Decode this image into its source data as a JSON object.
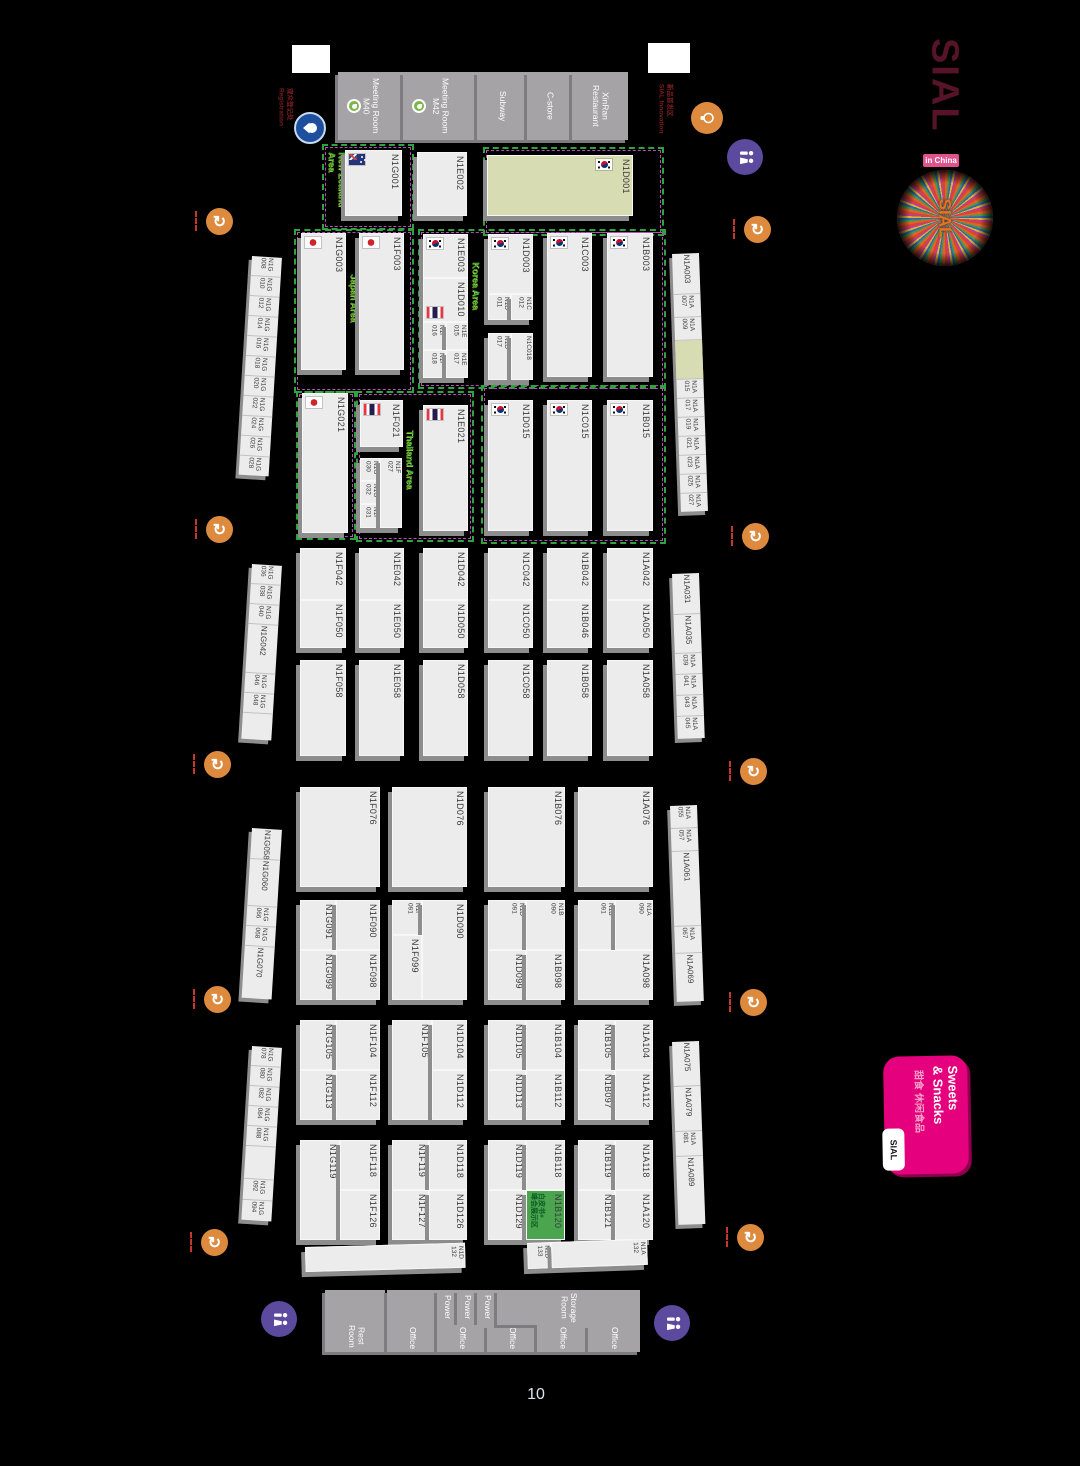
{
  "page_number": "10",
  "sial": {
    "name": "SIAL",
    "badge": "in China",
    "burst": "SIAL"
  },
  "sweets": {
    "title": "Sweets\n& Snacks",
    "cn": "甜食 休闲食品",
    "corner": "SIAL"
  },
  "notes": {
    "registration": "观众登记处\nRegistration",
    "innovation": "新品首发区\nSIAL Innovation"
  },
  "colors": {
    "booth": "#ececec",
    "olive": "#d8dcb2",
    "green_booth": "#4aa54e",
    "area_green": "#2fa43c",
    "area_purple": "#bb4abb",
    "pink": "#e5007d",
    "orange_icon": "#dd8a3e",
    "wc_icon": "#5b4a9e"
  },
  "gaps": [
    {
      "x": 292,
      "y": 45,
      "w": 38,
      "h": 28
    },
    {
      "x": 648,
      "y": 43,
      "w": 42,
      "h": 30
    }
  ],
  "rooms": [
    {
      "x": 338,
      "y": 72,
      "w": 65,
      "h": 68,
      "label": "Meeting Room\nM40",
      "dot": true
    },
    {
      "x": 403,
      "y": 72,
      "w": 74,
      "h": 68,
      "label": "Meeting Room\nM42",
      "dot": true
    },
    {
      "x": 477,
      "y": 72,
      "w": 50,
      "h": 68,
      "label": "Subway"
    },
    {
      "x": 527,
      "y": 72,
      "w": 45,
      "h": 68,
      "label": "C-store"
    },
    {
      "x": 572,
      "y": 72,
      "w": 56,
      "h": 68,
      "label": "XinRan\nRestaurant"
    },
    {
      "x": 325,
      "y": 1290,
      "w": 60,
      "h": 30,
      "label": ""
    },
    {
      "x": 325,
      "y": 1320,
      "w": 62,
      "h": 32,
      "label": "Rest\nRoom"
    },
    {
      "x": 387,
      "y": 1290,
      "w": 50,
      "h": 35,
      "label": ""
    },
    {
      "x": 387,
      "y": 1325,
      "w": 50,
      "h": 27,
      "label": "Office"
    },
    {
      "x": 437,
      "y": 1290,
      "w": 20,
      "h": 35,
      "label": "Power"
    },
    {
      "x": 457,
      "y": 1290,
      "w": 20,
      "h": 35,
      "label": "Power"
    },
    {
      "x": 477,
      "y": 1290,
      "w": 20,
      "h": 35,
      "label": "Power"
    },
    {
      "x": 437,
      "y": 1325,
      "w": 50,
      "h": 27,
      "label": "Office"
    },
    {
      "x": 487,
      "y": 1325,
      "w": 50,
      "h": 27,
      "label": "Office"
    },
    {
      "x": 497,
      "y": 1290,
      "w": 143,
      "h": 35,
      "label": "Storage\nRoom"
    },
    {
      "x": 537,
      "y": 1325,
      "w": 51,
      "h": 27,
      "label": "Office"
    },
    {
      "x": 588,
      "y": 1325,
      "w": 52,
      "h": 27,
      "label": "Office"
    }
  ],
  "areas": [
    {
      "x": 322,
      "y": 144,
      "w": 88,
      "h": 82,
      "label": "New Zealand Area",
      "lx": 327,
      "ly": 152,
      "lh": 66
    },
    {
      "x": 294,
      "y": 229,
      "w": 116,
      "h": 160,
      "label": "Japan Area",
      "lx": 349,
      "ly": 274,
      "lh": 80
    },
    {
      "x": 296,
      "y": 391,
      "w": 56,
      "h": 145,
      "label": "",
      "lx": 0,
      "ly": 0,
      "lh": 0
    },
    {
      "x": 356,
      "y": 391,
      "w": 114,
      "h": 147,
      "label": "Thailand Area",
      "lx": 405,
      "ly": 430,
      "lh": 88
    },
    {
      "x": 483,
      "y": 147,
      "w": 177,
      "h": 85,
      "label": "",
      "lx": 0,
      "ly": 0,
      "lh": 0
    },
    {
      "x": 418,
      "y": 229,
      "w": 244,
      "h": 156,
      "label": "Korea Area",
      "lx": 471,
      "ly": 262,
      "lh": 72
    },
    {
      "x": 481,
      "y": 385,
      "w": 181,
      "h": 155,
      "label": "",
      "lx": 0,
      "ly": 0,
      "lh": 0
    }
  ],
  "booths": [
    {
      "id": "N1G001",
      "x": 345,
      "y": 150,
      "w": 57,
      "h": 66,
      "flag": "nz"
    },
    {
      "id": "N1E002",
      "x": 417,
      "y": 152,
      "w": 50,
      "h": 64
    },
    {
      "id": "N1D001",
      "x": 487,
      "y": 155,
      "w": 146,
      "h": 61,
      "flag": "kr",
      "flagpos": "r",
      "fill": "olive"
    },
    {
      "id": "N1G003",
      "x": 301,
      "y": 233,
      "w": 45,
      "h": 137,
      "flag": "jp"
    },
    {
      "id": "N1F003",
      "x": 359,
      "y": 233,
      "w": 45,
      "h": 137,
      "flag": "jp"
    },
    {
      "id": "N1E003",
      "x": 423,
      "y": 234,
      "w": 45,
      "h": 44,
      "flag": "kr"
    },
    {
      "id": "N1D010",
      "x": 423,
      "y": 278,
      "w": 45,
      "h": 44,
      "flag": "th",
      "flagpos": "bl"
    },
    {
      "id": "N1F016",
      "x": 423,
      "y": 322,
      "w": 23,
      "h": 28,
      "wrap": true
    },
    {
      "id": "N1E015",
      "x": 446,
      "y": 322,
      "w": 22,
      "h": 28,
      "wrap": true
    },
    {
      "id": "N1F018",
      "x": 423,
      "y": 350,
      "w": 23,
      "h": 28,
      "wrap": true
    },
    {
      "id": "N1E017",
      "x": 446,
      "y": 350,
      "w": 22,
      "h": 28,
      "wrap": true
    },
    {
      "id": "N1D003",
      "x": 488,
      "y": 234,
      "w": 45,
      "h": 60,
      "flag": "kr"
    },
    {
      "id": "N1D011",
      "x": 488,
      "y": 294,
      "w": 23,
      "h": 26,
      "wrap": true
    },
    {
      "id": "N1C012",
      "x": 511,
      "y": 294,
      "w": 22,
      "h": 26,
      "wrap": true
    },
    {
      "id": "N1D017",
      "x": 488,
      "y": 333,
      "w": 23,
      "h": 47,
      "wrap": true
    },
    {
      "id": "N1C018",
      "x": 511,
      "y": 333,
      "w": 22,
      "h": 47,
      "small": true
    },
    {
      "id": "N1C003",
      "x": 547,
      "y": 233,
      "w": 45,
      "h": 144,
      "flag": "kr"
    },
    {
      "id": "N1B003",
      "x": 607,
      "y": 233,
      "w": 46,
      "h": 144,
      "flag": "kr"
    },
    {
      "id": "N1G021",
      "x": 302,
      "y": 393,
      "w": 46,
      "h": 140,
      "flag": "jp"
    },
    {
      "id": "N1F021",
      "x": 360,
      "y": 400,
      "w": 43,
      "h": 47,
      "flag": "th"
    },
    {
      "id": "N1G030",
      "x": 360,
      "y": 458,
      "w": 20,
      "h": 23,
      "wrap": true
    },
    {
      "id": "N1G032",
      "x": 360,
      "y": 481,
      "w": 20,
      "h": 23,
      "wrap": true
    },
    {
      "id": "N1F031",
      "x": 360,
      "y": 504,
      "w": 20,
      "h": 24,
      "wrap": true
    },
    {
      "id": "N1F027",
      "x": 380,
      "y": 458,
      "w": 22,
      "h": 70,
      "wrap": true
    },
    {
      "id": "N1E021",
      "x": 423,
      "y": 405,
      "w": 45,
      "h": 126,
      "flag": "th"
    },
    {
      "id": "N1D015",
      "x": 488,
      "y": 400,
      "w": 45,
      "h": 131,
      "flag": "kr"
    },
    {
      "id": "N1C015",
      "x": 547,
      "y": 400,
      "w": 45,
      "h": 131,
      "flag": "kr"
    },
    {
      "id": "N1B015",
      "x": 607,
      "y": 400,
      "w": 46,
      "h": 131,
      "flag": "kr"
    },
    {
      "id": "N1F042",
      "x": 300,
      "y": 548,
      "w": 46,
      "h": 52
    },
    {
      "id": "N1F050",
      "x": 300,
      "y": 600,
      "w": 46,
      "h": 48
    },
    {
      "id": "N1E042",
      "x": 359,
      "y": 548,
      "w": 45,
      "h": 52
    },
    {
      "id": "N1E050",
      "x": 359,
      "y": 600,
      "w": 45,
      "h": 48
    },
    {
      "id": "N1D042",
      "x": 423,
      "y": 548,
      "w": 45,
      "h": 52
    },
    {
      "id": "N1D050",
      "x": 423,
      "y": 600,
      "w": 45,
      "h": 48
    },
    {
      "id": "N1C042",
      "x": 488,
      "y": 548,
      "w": 45,
      "h": 52
    },
    {
      "id": "N1C050",
      "x": 488,
      "y": 600,
      "w": 45,
      "h": 48
    },
    {
      "id": "N1B042",
      "x": 547,
      "y": 548,
      "w": 45,
      "h": 52
    },
    {
      "id": "N1B046",
      "x": 547,
      "y": 600,
      "w": 45,
      "h": 48
    },
    {
      "id": "N1A042",
      "x": 607,
      "y": 548,
      "w": 46,
      "h": 52
    },
    {
      "id": "N1A050",
      "x": 607,
      "y": 600,
      "w": 46,
      "h": 48
    },
    {
      "id": "N1F058",
      "x": 300,
      "y": 660,
      "w": 46,
      "h": 96
    },
    {
      "id": "N1E058",
      "x": 359,
      "y": 660,
      "w": 45,
      "h": 96
    },
    {
      "id": "N1D058",
      "x": 423,
      "y": 660,
      "w": 45,
      "h": 96
    },
    {
      "id": "N1C058",
      "x": 488,
      "y": 660,
      "w": 45,
      "h": 96
    },
    {
      "id": "N1B058",
      "x": 547,
      "y": 660,
      "w": 45,
      "h": 96
    },
    {
      "id": "N1A058",
      "x": 607,
      "y": 660,
      "w": 46,
      "h": 96
    },
    {
      "id": "N1F076",
      "x": 300,
      "y": 787,
      "w": 80,
      "h": 100
    },
    {
      "id": "N1D076",
      "x": 392,
      "y": 787,
      "w": 75,
      "h": 100
    },
    {
      "id": "N1B076",
      "x": 488,
      "y": 787,
      "w": 77,
      "h": 100
    },
    {
      "id": "N1A076",
      "x": 578,
      "y": 787,
      "w": 75,
      "h": 100
    },
    {
      "id": "N1G091",
      "x": 300,
      "y": 900,
      "w": 36,
      "h": 50
    },
    {
      "id": "N1F090",
      "x": 336,
      "y": 900,
      "w": 44,
      "h": 50
    },
    {
      "id": "N1G099",
      "x": 300,
      "y": 950,
      "w": 36,
      "h": 50
    },
    {
      "id": "N1F098",
      "x": 336,
      "y": 950,
      "w": 44,
      "h": 50
    },
    {
      "id": "N1F091",
      "x": 392,
      "y": 900,
      "w": 30,
      "h": 35,
      "wrap": true
    },
    {
      "id": "N1D090",
      "x": 422,
      "y": 900,
      "w": 45,
      "h": 100
    },
    {
      "id": "N1F099",
      "x": 392,
      "y": 935,
      "w": 30,
      "h": 65
    },
    {
      "id": "N1D091",
      "x": 488,
      "y": 900,
      "w": 38,
      "h": 50,
      "wrap": true
    },
    {
      "id": "N1B090",
      "x": 526,
      "y": 900,
      "w": 39,
      "h": 50,
      "wrap": true
    },
    {
      "id": "N1D099",
      "x": 488,
      "y": 950,
      "w": 38,
      "h": 50
    },
    {
      "id": "N1B098",
      "x": 526,
      "y": 950,
      "w": 39,
      "h": 50
    },
    {
      "id": "N1B091",
      "x": 578,
      "y": 900,
      "w": 37,
      "h": 50,
      "wrap": true
    },
    {
      "id": "N1A090",
      "x": 615,
      "y": 900,
      "w": 38,
      "h": 50,
      "wrap": true
    },
    {
      "id": "N1A098",
      "x": 578,
      "y": 950,
      "w": 75,
      "h": 50
    },
    {
      "id": "N1G105",
      "x": 300,
      "y": 1020,
      "w": 36,
      "h": 50
    },
    {
      "id": "N1F104",
      "x": 336,
      "y": 1020,
      "w": 44,
      "h": 50
    },
    {
      "id": "N1G113",
      "x": 300,
      "y": 1070,
      "w": 36,
      "h": 50
    },
    {
      "id": "N1F112",
      "x": 336,
      "y": 1070,
      "w": 44,
      "h": 50
    },
    {
      "id": "N1F105",
      "x": 392,
      "y": 1020,
      "w": 40,
      "h": 100
    },
    {
      "id": "N1D104",
      "x": 432,
      "y": 1020,
      "w": 35,
      "h": 50
    },
    {
      "id": "N1D112",
      "x": 432,
      "y": 1070,
      "w": 35,
      "h": 50
    },
    {
      "id": "N1D105",
      "x": 488,
      "y": 1020,
      "w": 38,
      "h": 50
    },
    {
      "id": "N1B104",
      "x": 526,
      "y": 1020,
      "w": 39,
      "h": 50
    },
    {
      "id": "N1D113",
      "x": 488,
      "y": 1070,
      "w": 38,
      "h": 50
    },
    {
      "id": "N1B112",
      "x": 526,
      "y": 1070,
      "w": 39,
      "h": 50
    },
    {
      "id": "N1B105",
      "x": 578,
      "y": 1020,
      "w": 37,
      "h": 50
    },
    {
      "id": "N1A104",
      "x": 615,
      "y": 1020,
      "w": 38,
      "h": 50
    },
    {
      "id": "N1B097",
      "x": 578,
      "y": 1070,
      "w": 37,
      "h": 50
    },
    {
      "id": "N1A112",
      "x": 615,
      "y": 1070,
      "w": 38,
      "h": 50
    },
    {
      "id": "N1G119",
      "x": 300,
      "y": 1140,
      "w": 40,
      "h": 100
    },
    {
      "id": "N1F118",
      "x": 340,
      "y": 1140,
      "w": 40,
      "h": 50
    },
    {
      "id": "N1F126",
      "x": 340,
      "y": 1190,
      "w": 40,
      "h": 50
    },
    {
      "id": "N1F119",
      "x": 392,
      "y": 1140,
      "w": 37,
      "h": 50
    },
    {
      "id": "N1D118",
      "x": 429,
      "y": 1140,
      "w": 38,
      "h": 50
    },
    {
      "id": "N1F127",
      "x": 392,
      "y": 1190,
      "w": 37,
      "h": 50
    },
    {
      "id": "N1D126",
      "x": 429,
      "y": 1190,
      "w": 38,
      "h": 50
    },
    {
      "id": "N1D119",
      "x": 488,
      "y": 1140,
      "w": 38,
      "h": 50
    },
    {
      "id": "N1B118",
      "x": 526,
      "y": 1140,
      "w": 39,
      "h": 50
    },
    {
      "id": "N1D129",
      "x": 488,
      "y": 1190,
      "w": 38,
      "h": 50
    },
    {
      "id": "N1B120",
      "x": 526,
      "y": 1190,
      "w": 39,
      "h": 50,
      "fill": "green",
      "note": "白皮书+\n峰会展示区"
    },
    {
      "id": "N1B119",
      "x": 578,
      "y": 1140,
      "w": 37,
      "h": 50
    },
    {
      "id": "N1A118",
      "x": 615,
      "y": 1140,
      "w": 38,
      "h": 50
    },
    {
      "id": "N1B121",
      "x": 578,
      "y": 1190,
      "w": 37,
      "h": 50
    },
    {
      "id": "N1A120",
      "x": 615,
      "y": 1190,
      "w": 38,
      "h": 50
    }
  ],
  "strips": [
    {
      "x": 252,
      "y": 256,
      "w": 30,
      "rot": 3.5,
      "cells": [
        {
          "id": "N1G008",
          "h": 19
        },
        {
          "id": "N1G010",
          "h": 19
        },
        {
          "id": "N1G012",
          "h": 19
        },
        {
          "id": "N1G014",
          "h": 19
        },
        {
          "id": "N1G016",
          "h": 19
        },
        {
          "id": "N1G018",
          "h": 19
        },
        {
          "id": "N1G020",
          "h": 19
        },
        {
          "id": "N1G022",
          "h": 19
        },
        {
          "id": "N1G024",
          "h": 19
        },
        {
          "id": "N1G026",
          "h": 19
        },
        {
          "id": "N1G028",
          "h": 19
        }
      ]
    },
    {
      "x": 252,
      "y": 564,
      "w": 30,
      "rot": 3.5,
      "cells": [
        {
          "id": "N1G036",
          "h": 19
        },
        {
          "id": "N1G038",
          "h": 19
        },
        {
          "id": "N1G040",
          "h": 19
        },
        {
          "id": "N1G042",
          "h": 48,
          "big": true
        },
        {
          "id": "N1G046",
          "h": 19
        },
        {
          "id": "N1G048",
          "h": 19
        },
        {
          "id": "",
          "h": 26
        }
      ]
    },
    {
      "x": 252,
      "y": 828,
      "w": 30,
      "rot": 3.5,
      "cells": [
        {
          "id": "N1G058",
          "h": 30,
          "big": true
        },
        {
          "id": "N1G060",
          "h": 46,
          "big": true
        },
        {
          "id": "N1G066",
          "h": 19
        },
        {
          "id": "N1G068",
          "h": 19
        },
        {
          "id": "N1G070",
          "h": 52,
          "big": true
        }
      ]
    },
    {
      "x": 252,
      "y": 1046,
      "w": 30,
      "rot": 3.5,
      "cells": [
        {
          "id": "N1G078",
          "h": 19
        },
        {
          "id": "N1G080",
          "h": 19
        },
        {
          "id": "N1G082",
          "h": 19
        },
        {
          "id": "N1G084",
          "h": 19
        },
        {
          "id": "N1G088",
          "h": 19
        },
        {
          "id": "",
          "h": 32
        },
        {
          "id": "N1G092",
          "h": 20
        },
        {
          "id": "N1G094",
          "h": 20
        }
      ]
    },
    {
      "x": 672,
      "y": 254,
      "w": 27,
      "rot": -2,
      "cells": [
        {
          "id": "N1A003",
          "h": 40,
          "big": true
        },
        {
          "id": "N1A007",
          "h": 22
        },
        {
          "id": "N1A009",
          "h": 22
        },
        {
          "id": "",
          "h": 38,
          "fill": "olive"
        },
        {
          "id": "N1A015",
          "h": 18
        },
        {
          "id": "N1A017",
          "h": 18
        },
        {
          "id": "N1A019",
          "h": 18
        },
        {
          "id": "N1A021",
          "h": 18
        },
        {
          "id": "N1A023",
          "h": 18
        },
        {
          "id": "N1A025",
          "h": 18
        },
        {
          "id": "N1A027",
          "h": 18
        }
      ]
    },
    {
      "x": 672,
      "y": 574,
      "w": 27,
      "rot": -2,
      "cells": [
        {
          "id": "N1A031",
          "h": 40,
          "big": true
        },
        {
          "id": "N1A035",
          "h": 38,
          "big": true
        },
        {
          "id": "N1A039",
          "h": 20
        },
        {
          "id": "N1A041",
          "h": 20
        },
        {
          "id": "N1A043",
          "h": 20
        },
        {
          "id": "N1A045",
          "h": 22
        }
      ]
    },
    {
      "x": 670,
      "y": 806,
      "w": 27,
      "rot": -2,
      "cells": [
        {
          "id": "N1A055",
          "h": 22
        },
        {
          "id": "N1A057",
          "h": 22
        },
        {
          "id": "N1A061",
          "h": 74,
          "big": true
        },
        {
          "id": "N1A067",
          "h": 26
        },
        {
          "id": "N1A069",
          "h": 48,
          "big": true
        }
      ]
    },
    {
      "x": 672,
      "y": 1042,
      "w": 27,
      "rot": -2,
      "cells": [
        {
          "id": "N1A075",
          "h": 44,
          "big": true
        },
        {
          "id": "N1A079",
          "h": 44,
          "big": true
        },
        {
          "id": "N1A081",
          "h": 24
        },
        {
          "id": "N1A089",
          "h": 68,
          "big": true
        }
      ]
    }
  ],
  "groups": [
    {
      "x": 305,
      "y": 1247,
      "rot": -1.5,
      "cells": [
        {
          "id": "N1D132",
          "w": 160,
          "h": 25
        }
      ]
    },
    {
      "x": 527,
      "y": 1243,
      "rot": -2,
      "cells": [
        {
          "id": "N1D133",
          "w": 24,
          "h": 26
        },
        {
          "id": "N1A132",
          "w": 96,
          "h": 26
        }
      ]
    }
  ],
  "icons": [
    {
      "type": "refresh",
      "x": 206,
      "y": 208
    },
    {
      "type": "refresh",
      "x": 206,
      "y": 516
    },
    {
      "type": "refresh",
      "x": 204,
      "y": 751
    },
    {
      "type": "refresh",
      "x": 204,
      "y": 986
    },
    {
      "type": "refresh",
      "x": 201,
      "y": 1229
    },
    {
      "type": "refresh",
      "x": 744,
      "y": 216
    },
    {
      "type": "refresh",
      "x": 742,
      "y": 523
    },
    {
      "type": "refresh",
      "x": 740,
      "y": 758
    },
    {
      "type": "refresh",
      "x": 740,
      "y": 989
    },
    {
      "type": "refresh",
      "x": 737,
      "y": 1224
    },
    {
      "type": "wc",
      "x": 727,
      "y": 139
    },
    {
      "type": "wc",
      "x": 261,
      "y": 1301
    },
    {
      "type": "wc",
      "x": 654,
      "y": 1305
    },
    {
      "type": "drop",
      "x": 294,
      "y": 112
    },
    {
      "type": "bulb",
      "x": 691,
      "y": 102
    }
  ]
}
